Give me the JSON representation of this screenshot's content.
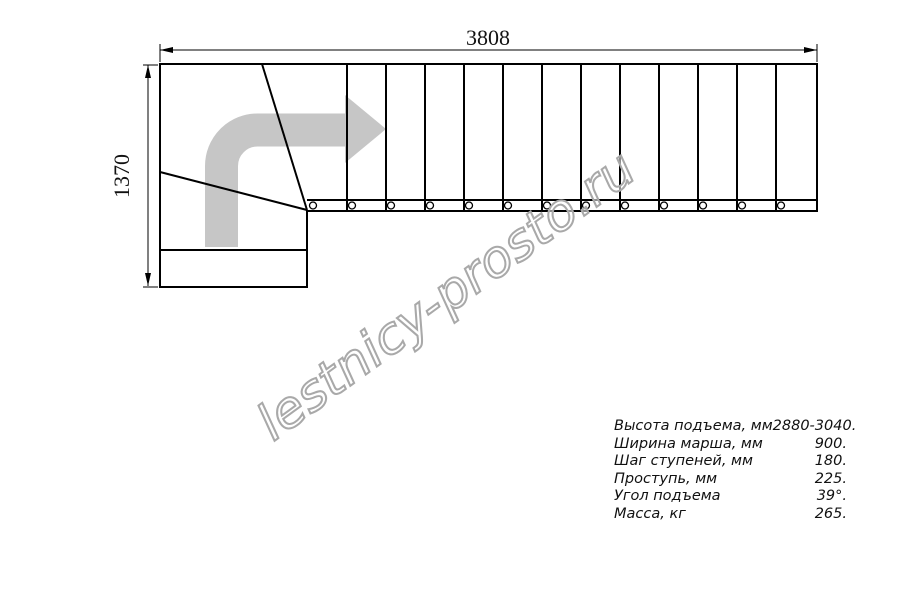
{
  "page": {
    "background": "#ffffff"
  },
  "colors": {
    "line": "#000000",
    "text": "#111111",
    "arrow_fill": "#c6c6c6",
    "watermark_stroke": "#a9a9a9",
    "watermark_fill": "rgba(255,255,255,0.55)",
    "page_bg": "#ffffff"
  },
  "dimensions": {
    "horizontal": {
      "label": "3808"
    },
    "vertical": {
      "label": "1370"
    }
  },
  "stairs": {
    "tread_lines": {
      "start_x": 347,
      "spacing": 39,
      "count": 12,
      "top_y": 64,
      "bottom_y": 211
    },
    "balusters": {
      "start_x": 313,
      "spacing": 39,
      "count": 13,
      "center_y": 205.5,
      "radius": 3.5
    }
  },
  "watermark": {
    "text": "lestnicy-prosto.ru"
  },
  "specs": {
    "rows": [
      {
        "label": "Высота подъема, мм",
        "value": "2880-3040."
      },
      {
        "label": "Ширина марша, мм",
        "value": "900."
      },
      {
        "label": "Шаг ступеней, мм",
        "value": "180."
      },
      {
        "label": "Проступь, мм",
        "value": "225."
      },
      {
        "label": "Угол подъема",
        "value": "39°."
      },
      {
        "label": "Масса, кг",
        "value": "265."
      }
    ]
  }
}
